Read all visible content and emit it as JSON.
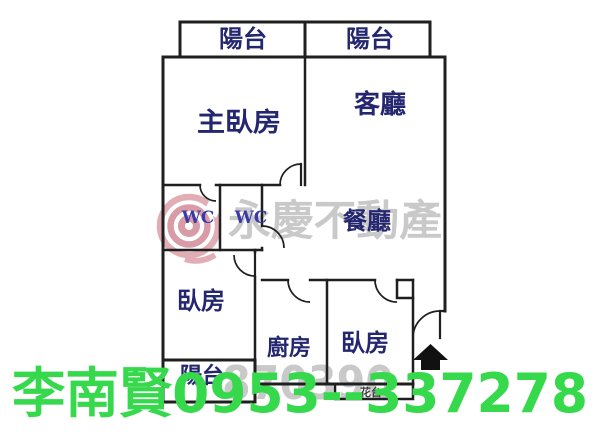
{
  "image": {
    "width": 600,
    "height": 443,
    "background": "#ffffff"
  },
  "colors": {
    "wall": "#1f1f1f",
    "room_label_navy": "#24276f",
    "wc_navy": "#3a3aa8",
    "small_label_gray": "#3c3c3c",
    "watermark_gray": "#c9c9c9",
    "logo_pink": "#d08490",
    "logo_pink_light": "#dc9aa4",
    "arrow_black": "#111111",
    "contact_green": "#36d94c"
  },
  "plan": {
    "rooms": {
      "balcony_top_left": "陽台",
      "balcony_top_right": "陽台",
      "master_bedroom": "主臥房",
      "living_room": "客廳",
      "wc_left": "WC",
      "wc_right": "WC",
      "dining_room": "餐廳",
      "bedroom_left": "臥房",
      "kitchen": "廚房",
      "bedroom_right": "臥房",
      "balcony_bottom": "陽台",
      "flower_stand": "花台"
    },
    "entrance_icon": "up-arrow"
  },
  "watermark": {
    "brand_text": "永慶不動產",
    "logo": "yungching-rings-logo",
    "photo_id": "870390"
  },
  "contact": {
    "text": "李南賢0953--337278",
    "agent_name": "李南賢",
    "phone": "0953--337278"
  }
}
